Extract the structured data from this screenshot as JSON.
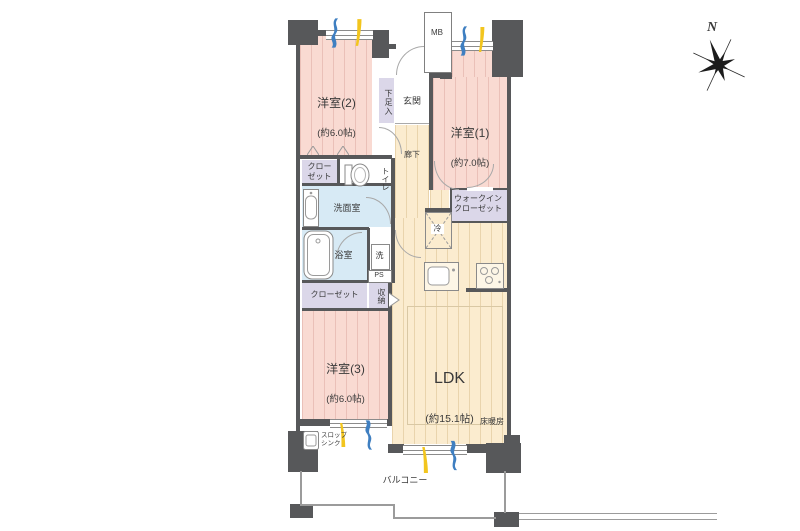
{
  "meta": {
    "type": "apartment-floor-plan"
  },
  "colors": {
    "wall": "#57585a",
    "room_pink": "#f9dad2",
    "room_beige": "#fbeccf",
    "room_blue": "#d7eaf5",
    "room_lavender": "#dbd7e9",
    "curtain_blue": "#3f7fc1",
    "curtain_yellow": "#f2c51e"
  },
  "rooms": {
    "western2": {
      "name": "洋室(2)",
      "size": "(約6.0帖)"
    },
    "western1": {
      "name": "洋室(1)",
      "size": "(約7.0帖)"
    },
    "western3": {
      "name": "洋室(3)",
      "size": "(約6.0帖)"
    },
    "ldk": {
      "name": "LDK",
      "size": "(約15.1帖)"
    }
  },
  "labels": {
    "entrance": "玄関",
    "hallway": "廊下",
    "shoe_cabinet": "下足入",
    "meter_box": "MB",
    "toilet": "トイレ",
    "washroom": "洗面室",
    "bathroom": "浴室",
    "washer": "洗",
    "pipe_space": "PS",
    "closet_upper": "クロー\nゼット",
    "closet_lower": "クローゼット",
    "storage": "収納",
    "walk_in_closet": "ウォークイン\nクローゼット",
    "refrigerator": "冷",
    "floor_heating": "床暖房",
    "slop_sink": "スロップ\nシンク",
    "balcony": "バルコニー",
    "compass_north": "N"
  }
}
